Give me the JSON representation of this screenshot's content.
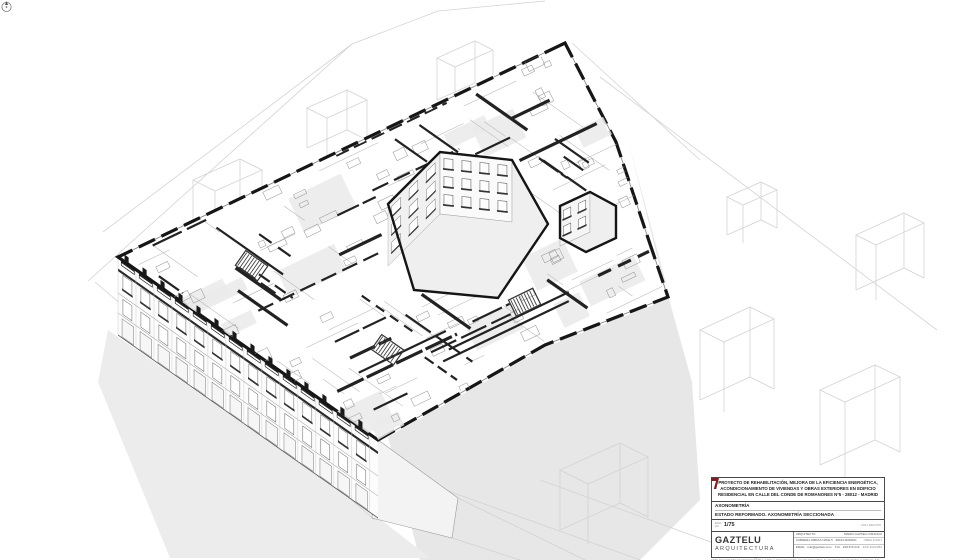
{
  "page": {
    "background": "#ffffff"
  },
  "colors": {
    "cut_wall": "#1a1a1a",
    "light_wall": "#eaeaea",
    "shadow": "#e7e7e7",
    "context_line": "#d3d3d3",
    "accent_red": "#7d1f24"
  },
  "title_block": {
    "project_title_lines": [
      "PROYECTO DE REHABILITACIÓN, MEJORA DE LA EFICIENCIA ENERGÉTICA,",
      "ACONDICIONAMIENTO DE VIVIENDAS Y OBRAS EXTERIORES EN EDIFICIO",
      "RESIDENCIAL EN CALLE DEL CONDE DE ROMANONES Nº5 - 28012 - MADRID"
    ],
    "drawing_category": "AXONOMETRÍA",
    "drawing_title": "ESTADO REFORMADO. AXONOMETRÍA SECCIONADA",
    "scale_prefix": "ESC.",
    "scale_sheet": "A3",
    "scale_value": "1/75",
    "revision_code": "2021.REF.P05",
    "firm": {
      "name": "GAZTELU",
      "subtitle": "ARQUITECTURA"
    },
    "contact": {
      "row1_label": "ARQUITECTO",
      "row1_value": "MARIO GAZTELU FRANCO",
      "row2_value": "CABRERA OBRAS NAVE 5 · 28014 MADRID",
      "row2_right": "OBRA 4/2021",
      "row3_value": "EMAIL · info@gaztelu.com",
      "row3_tlf": "TLF · 918 670 219",
      "row3_right": "EXP 2021/083"
    },
    "fine_print_lines": [
      "ESTE DOCUMENTO ES PROPIEDAD DE GAZTELU ARQUITECTURA. QUEDA PROHIBIDA SU REPRODUCCIÓN TOTAL O PARCIAL SIN AUTORIZACIÓN EXPRESA DEL AUTOR.",
      "LAS COTAS PREVALECEN SOBRE LA MEDICIÓN EN PLANO. COMPROBAR DIMENSIONES EN OBRA ANTES DE LA EJECUCIÓN DE LOS TRABAJOS."
    ]
  },
  "icons": {
    "compass": "north-arrow-icon",
    "logo_mark": "gaztelu-logo-mark"
  }
}
